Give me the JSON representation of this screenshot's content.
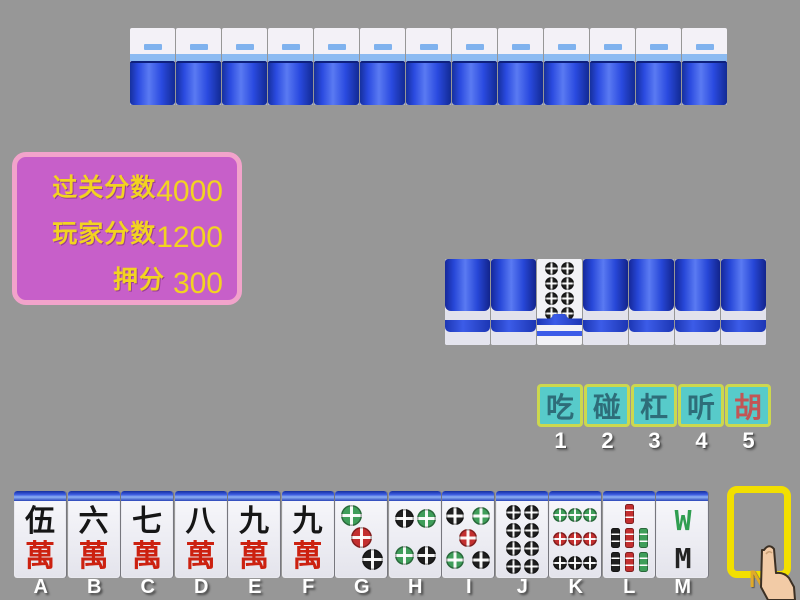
{
  "window": {
    "title": "Mahjong game table"
  },
  "colors": {
    "background": "#979797",
    "tile_back_blue": "#2a4ae0",
    "score_panel_fill": "#c75fc9",
    "score_panel_border": "#f2a3cb",
    "score_text_yellow": "#f2d321",
    "button_fill": "#57cbca",
    "button_border": "#ccd84e",
    "button_text": "#2e6d79",
    "button_text_hu": "#c25555",
    "draw_slot_border": "#f2df00"
  },
  "opponent_row": {
    "tile_count": 13,
    "tile_kind": "face-down-back"
  },
  "score_panel": {
    "rows": [
      {
        "label": "过关分数",
        "value": "4000"
      },
      {
        "label": "玩家分数",
        "value": "1200"
      },
      {
        "label": "押分",
        "value": "300"
      }
    ]
  },
  "meld_row": {
    "tiles": [
      {
        "type": "back"
      },
      {
        "type": "back"
      },
      {
        "type": "face",
        "suit": "dots",
        "value": 8
      },
      {
        "type": "back"
      },
      {
        "type": "back"
      },
      {
        "type": "back"
      },
      {
        "type": "back"
      }
    ]
  },
  "action_buttons": {
    "items": [
      {
        "label": "吃",
        "hotkey": "1",
        "text_color": "#2e6d79"
      },
      {
        "label": "碰",
        "hotkey": "2",
        "text_color": "#2e6d79"
      },
      {
        "label": "杠",
        "hotkey": "3",
        "text_color": "#2e6d79"
      },
      {
        "label": "听",
        "hotkey": "4",
        "text_color": "#2e6d79"
      },
      {
        "label": "胡",
        "hotkey": "5",
        "text_color": "#c25555"
      }
    ]
  },
  "hand": {
    "tiles": [
      {
        "key": "A",
        "kind": "wan",
        "top": "伍",
        "bottom": "萬",
        "name": "5-wan"
      },
      {
        "key": "B",
        "kind": "wan",
        "top": "六",
        "bottom": "萬",
        "name": "6-wan"
      },
      {
        "key": "C",
        "kind": "wan",
        "top": "七",
        "bottom": "萬",
        "name": "7-wan"
      },
      {
        "key": "D",
        "kind": "wan",
        "top": "八",
        "bottom": "萬",
        "name": "8-wan"
      },
      {
        "key": "E",
        "kind": "wan",
        "top": "九",
        "bottom": "萬",
        "name": "9-wan"
      },
      {
        "key": "F",
        "kind": "wan",
        "top": "九",
        "bottom": "萬",
        "name": "9-wan"
      },
      {
        "key": "G",
        "kind": "dots",
        "value": 3,
        "name": "3-dots"
      },
      {
        "key": "H",
        "kind": "dots",
        "value": 4,
        "name": "4-dots"
      },
      {
        "key": "I",
        "kind": "dots",
        "value": 5,
        "name": "5-dots"
      },
      {
        "key": "J",
        "kind": "dots",
        "value": 8,
        "name": "8-dots"
      },
      {
        "key": "K",
        "kind": "dots",
        "value": 9,
        "name": "9-dots"
      },
      {
        "key": "L",
        "kind": "sticks",
        "value": 7,
        "name": "7-bamboo"
      },
      {
        "key": "M",
        "kind": "sticks",
        "value": 8,
        "name": "8-bamboo",
        "wm": {
          "top_letter": "W",
          "top_color": "#2f9e50",
          "bottom_letter": "M",
          "bottom_color": "#222222"
        }
      }
    ],
    "draw_slot_key": "N"
  }
}
